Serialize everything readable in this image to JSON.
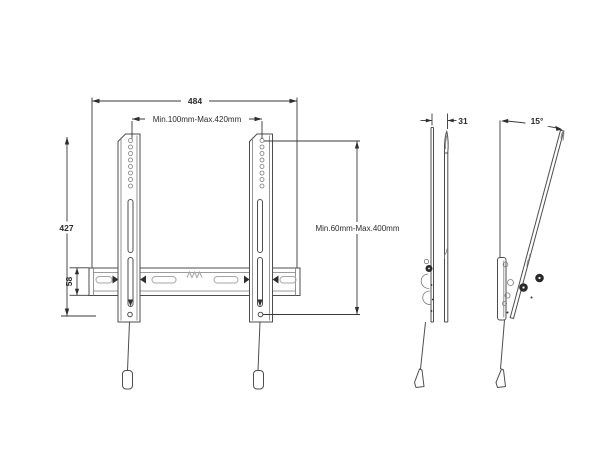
{
  "front_view": {
    "width_total": "484",
    "vesa_width_range": "Min.100mm-Max.420mm",
    "height_total": "427",
    "rail_height": "58",
    "vesa_height_range": "Min.60mm-Max.400mm"
  },
  "side_view": {
    "depth": "31"
  },
  "tilt_view": {
    "tilt_angle": "15°"
  },
  "colors": {
    "line": "#4d4d4d",
    "dimension": "#383838",
    "light_detail": "#a6a6a6",
    "background": "#ffffff"
  }
}
